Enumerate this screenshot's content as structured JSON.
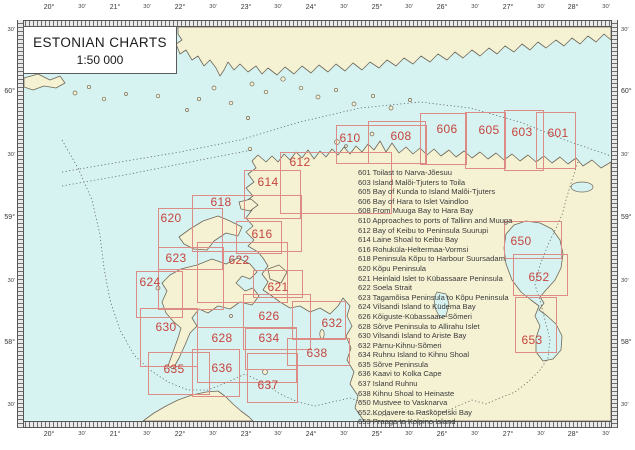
{
  "title_box": {
    "line1": "ESTONIAN CHARTS",
    "line2": "1:50 000"
  },
  "colors": {
    "water": "#d7f3f1",
    "land": "#f5f1d3",
    "coastline": "#6f6757",
    "box_border": "#dd8b85",
    "box_number": "#c6453e",
    "legend_text": "#3b3b3b",
    "axis_text": "#333333",
    "boundary_dotted": "#4a4a4a"
  },
  "axes": {
    "longitude": [
      {
        "text": "20°",
        "x": 49
      },
      {
        "text": "30'",
        "x": 82
      },
      {
        "text": "21°",
        "x": 115
      },
      {
        "text": "30'",
        "x": 147
      },
      {
        "text": "22°",
        "x": 180
      },
      {
        "text": "30'",
        "x": 213
      },
      {
        "text": "23°",
        "x": 246
      },
      {
        "text": "30'",
        "x": 278
      },
      {
        "text": "24°",
        "x": 311
      },
      {
        "text": "30'",
        "x": 344
      },
      {
        "text": "25°",
        "x": 377
      },
      {
        "text": "30'",
        "x": 409
      },
      {
        "text": "26°",
        "x": 442
      },
      {
        "text": "30'",
        "x": 475
      },
      {
        "text": "27°",
        "x": 508
      },
      {
        "text": "30'",
        "x": 541
      },
      {
        "text": "28°",
        "x": 573
      },
      {
        "text": "30'",
        "x": 606
      }
    ],
    "latitude": [
      {
        "text": "30'",
        "y": 30
      },
      {
        "text": "60°",
        "y": 92
      },
      {
        "text": "30'",
        "y": 155
      },
      {
        "text": "59°",
        "y": 218
      },
      {
        "text": "30'",
        "y": 281
      },
      {
        "text": "58°",
        "y": 343
      },
      {
        "text": "30'",
        "y": 405
      }
    ]
  },
  "charts": [
    {
      "num": "601",
      "x": 536,
      "y": 112,
      "w": 40,
      "h": 57,
      "nx": 558,
      "ny": 133
    },
    {
      "num": "603",
      "x": 504,
      "y": 110,
      "w": 40,
      "h": 61,
      "nx": 522,
      "ny": 132
    },
    {
      "num": "605",
      "x": 465,
      "y": 112,
      "w": 41,
      "h": 57,
      "nx": 489,
      "ny": 130
    },
    {
      "num": "606",
      "x": 420,
      "y": 113,
      "w": 47,
      "h": 52,
      "nx": 447,
      "ny": 129
    },
    {
      "num": "608",
      "x": 368,
      "y": 121,
      "w": 58,
      "h": 43,
      "nx": 401,
      "ny": 136
    },
    {
      "num": "610",
      "x": 336,
      "y": 125,
      "w": 91,
      "h": 39,
      "nx": 350,
      "ny": 138
    },
    {
      "num": "612",
      "x": 280,
      "y": 152,
      "w": 112,
      "h": 62,
      "nx": 300,
      "ny": 162
    },
    {
      "num": "614",
      "x": 244,
      "y": 170,
      "w": 57,
      "h": 49,
      "nx": 268,
      "ny": 182
    },
    {
      "num": "618",
      "x": 192,
      "y": 195,
      "w": 110,
      "h": 57,
      "nx": 221,
      "ny": 202
    },
    {
      "num": "620",
      "x": 158,
      "y": 208,
      "w": 65,
      "h": 62,
      "nx": 171,
      "ny": 218
    },
    {
      "num": "616",
      "x": 236,
      "y": 221,
      "w": 46,
      "h": 33,
      "nx": 262,
      "ny": 234
    },
    {
      "num": "622",
      "x": 197,
      "y": 242,
      "w": 91,
      "h": 61,
      "nx": 239,
      "ny": 260
    },
    {
      "num": "623",
      "x": 158,
      "y": 247,
      "w": 66,
      "h": 63,
      "nx": 176,
      "ny": 258
    },
    {
      "num": "624",
      "x": 136,
      "y": 271,
      "w": 47,
      "h": 47,
      "nx": 150,
      "ny": 282
    },
    {
      "num": "621",
      "x": 253,
      "y": 270,
      "w": 50,
      "h": 28,
      "nx": 278,
      "ny": 287
    },
    {
      "num": "626",
      "x": 243,
      "y": 294,
      "w": 68,
      "h": 56,
      "nx": 269,
      "ny": 316
    },
    {
      "num": "630",
      "x": 140,
      "y": 308,
      "w": 58,
      "h": 59,
      "nx": 166,
      "ny": 327
    },
    {
      "num": "632",
      "x": 292,
      "y": 301,
      "w": 54,
      "h": 39,
      "nx": 332,
      "ny": 323
    },
    {
      "num": "628",
      "x": 197,
      "y": 327,
      "w": 100,
      "h": 56,
      "nx": 222,
      "ny": 338
    },
    {
      "num": "634",
      "x": 245,
      "y": 328,
      "w": 52,
      "h": 42,
      "nx": 269,
      "ny": 338
    },
    {
      "num": "638",
      "x": 287,
      "y": 338,
      "w": 63,
      "h": 28,
      "nx": 317,
      "ny": 353
    },
    {
      "num": "635",
      "x": 148,
      "y": 352,
      "w": 62,
      "h": 43,
      "nx": 174,
      "ny": 369
    },
    {
      "num": "636",
      "x": 192,
      "y": 349,
      "w": 48,
      "h": 48,
      "nx": 222,
      "ny": 368
    },
    {
      "num": "637",
      "x": 247,
      "y": 353,
      "w": 51,
      "h": 50,
      "nx": 268,
      "ny": 385
    },
    {
      "num": "650",
      "x": 504,
      "y": 221,
      "w": 58,
      "h": 38,
      "nx": 521,
      "ny": 241
    },
    {
      "num": "652",
      "x": 513,
      "y": 254,
      "w": 55,
      "h": 42,
      "nx": 539,
      "ny": 277
    },
    {
      "num": "653",
      "x": 515,
      "y": 297,
      "w": 42,
      "h": 56,
      "nx": 532,
      "ny": 340
    }
  ],
  "legend": [
    {
      "num": "601",
      "name": "Toilast to Narva-Jõesuu"
    },
    {
      "num": "603",
      "name": "Island Malõi-Tjuters to Toila"
    },
    {
      "num": "605",
      "name": "Bay of Kunda to Island Malõi-Tjuters"
    },
    {
      "num": "606",
      "name": "Bay of Hara to Islet Vaindloo"
    },
    {
      "num": "608",
      "name": "From Muuga Bay to Hara Bay"
    },
    {
      "num": "610",
      "name": "Approaches to ports of Tallinn and Muuga"
    },
    {
      "num": "612",
      "name": "Bay of Keibu to Peninsula Suurupi"
    },
    {
      "num": "614",
      "name": "Laine Shoal to Keibu Bay"
    },
    {
      "num": "616",
      "name": "Rohuküla-Heltermaa-Vormsi"
    },
    {
      "num": "618",
      "name": "Peninsula Kõpu to Harbour Suursadam"
    },
    {
      "num": "620",
      "name": "Kõpu Peninsula"
    },
    {
      "num": "621",
      "name": "Heinlaid Islet to Kübassaare Peninsula"
    },
    {
      "num": "622",
      "name": "Soela Strait"
    },
    {
      "num": "623",
      "name": "Tagamõisa Peninsula to Kõpu Peninsula"
    },
    {
      "num": "624",
      "name": "Vilsandi Island to Küdema Bay"
    },
    {
      "num": "626",
      "name": "Kõiguste-Kübassaare-Sõmeri"
    },
    {
      "num": "628",
      "name": "Sõrve Peninsula to Allirahu Islet"
    },
    {
      "num": "630",
      "name": "Vilsandi Island to Ariste Bay"
    },
    {
      "num": "632",
      "name": "Pärnu-Kihnu-Sõmeri"
    },
    {
      "num": "634",
      "name": "Ruhnu Island to Kihnu Shoal"
    },
    {
      "num": "635",
      "name": "Sõrve Peninsula"
    },
    {
      "num": "636",
      "name": "Kaavi to Kolka Cape"
    },
    {
      "num": "637",
      "name": "Island Ruhnu"
    },
    {
      "num": "638",
      "name": "Kihnu Shoal to Heinaste"
    },
    {
      "num": "650",
      "name": "Mustvee to Vasknarva"
    },
    {
      "num": "652",
      "name": "Kodavere to Raskopelski Bay"
    },
    {
      "num": "653",
      "name": "Praaga to Kolpino Island"
    }
  ]
}
